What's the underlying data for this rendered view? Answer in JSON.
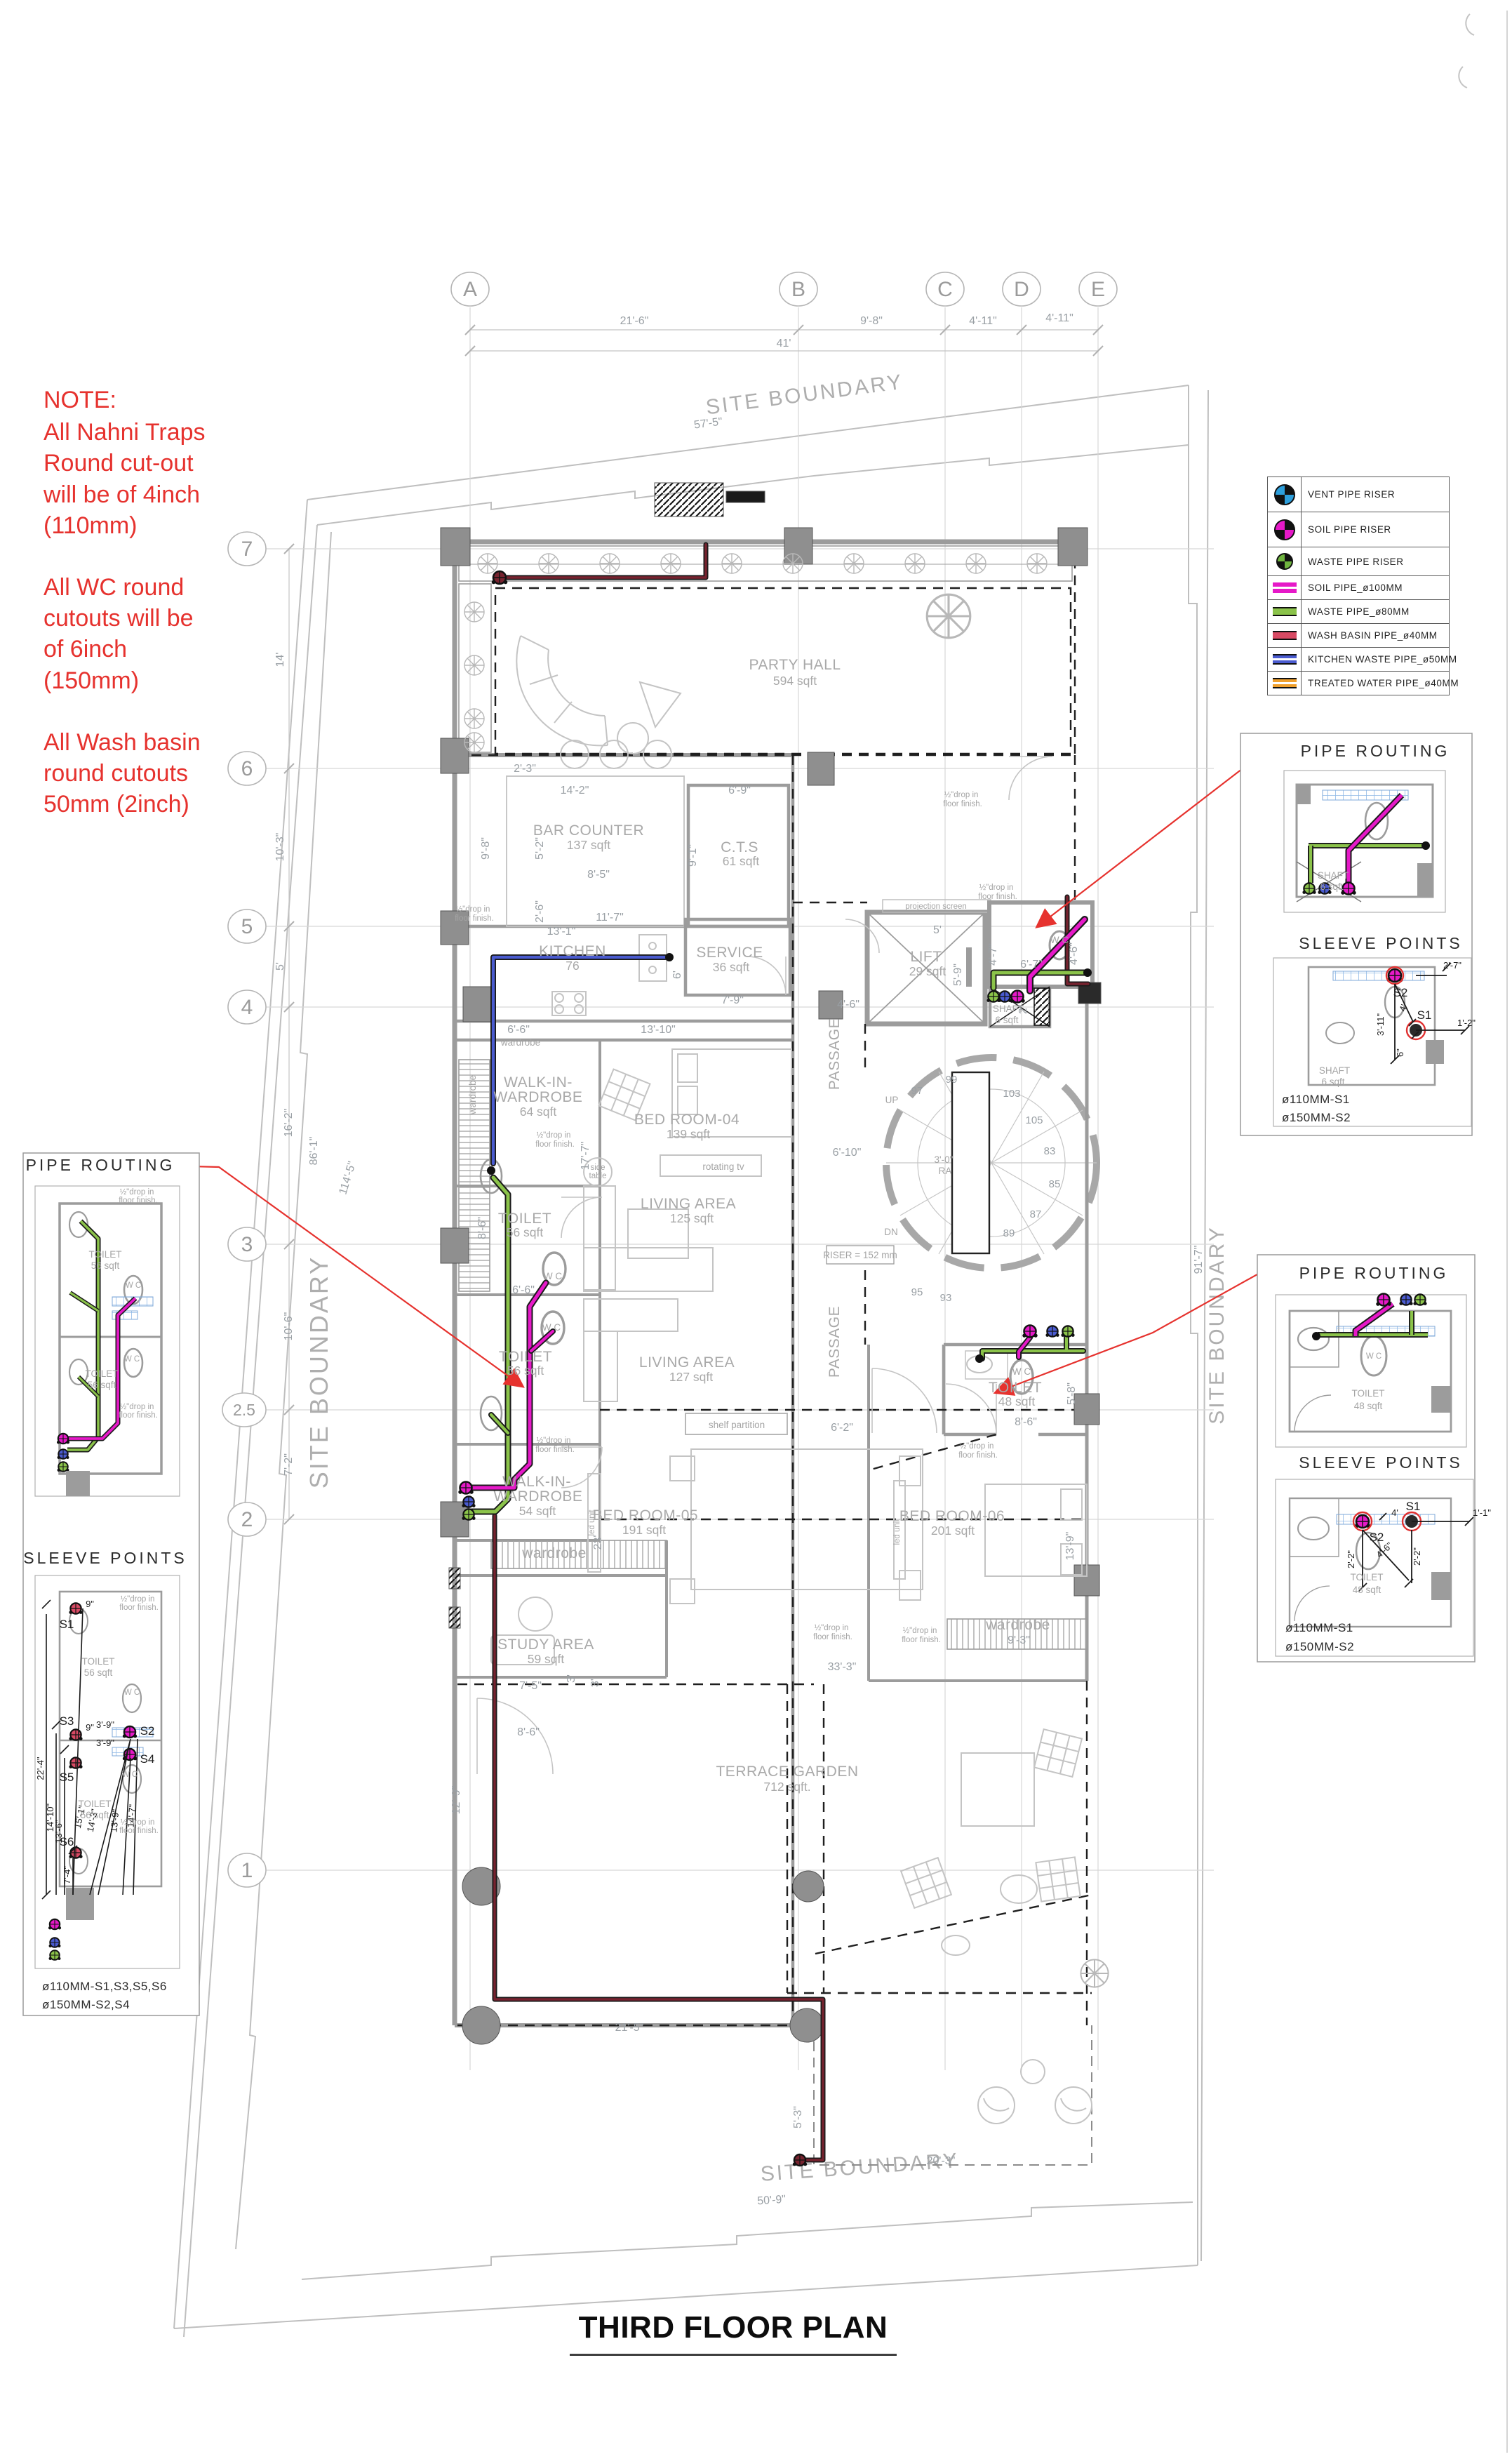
{
  "title": "THIRD FLOOR PLAN",
  "note": {
    "heading": "NOTE:",
    "p1": "All Nahni Traps\nRound cut-out\nwill be of 4inch\n(110mm)",
    "p2": "All WC round\ncutouts will be\nof 6inch\n(150mm)",
    "p3": "All Wash basin\nround cutouts\n50mm (2inch)"
  },
  "legend": {
    "items": [
      {
        "icon": "vent-pipe-riser-icon",
        "label": "VENT PIPE RISER",
        "color": "#2d9fdc"
      },
      {
        "icon": "soil-pipe-riser-icon",
        "label": "SOIL PIPE RISER",
        "color": "#e619c8"
      },
      {
        "icon": "waste-pipe-riser-icon",
        "label": "WASTE PIPE RISER",
        "color": "#6fb43f"
      },
      {
        "icon": "soil-pipe-line-icon",
        "label": "SOIL PIPE_ø100MM",
        "color": "#e619c8"
      },
      {
        "icon": "waste-pipe-line-icon",
        "label": "WASTE PIPE_ø80MM",
        "color": "#8bc34a"
      },
      {
        "icon": "wash-basin-pipe-icon",
        "label": "WASH BASIN PIPE_ø40MM",
        "color": "#d84a64"
      },
      {
        "icon": "kitchen-waste-pipe-icon",
        "label": "KITCHEN WASTE PIPE_ø50MM",
        "color": "#4a5bd0"
      },
      {
        "icon": "treated-water-pipe-icon",
        "label": "TREATED WATER PIPE_ø40MM",
        "color": "#f0a02c"
      }
    ]
  },
  "grid": {
    "cols": [
      "A",
      "B",
      "C",
      "D",
      "E"
    ],
    "rows": [
      "7",
      "6",
      "5",
      "4",
      "3",
      "2.5",
      "2",
      "1"
    ]
  },
  "dims": {
    "top": [
      "21'-6\"",
      "9'-8\"",
      "4'-11\"",
      "4'-11\"",
      "41'"
    ],
    "left": [
      "14'",
      "10'-3\"",
      "5'",
      "16'-2\"",
      "10'-6\"",
      "7'-2\""
    ],
    "boundary": {
      "label": "SITE BOUNDARY",
      "top": "57'-5\"",
      "left": "86'-1\"",
      "left_diag": "114'-5\"",
      "right": "91'-7\"",
      "bottom": "50'-9\""
    },
    "plan": [
      "2'-3\"",
      "14'-2\"",
      "6'-9\"",
      "9'-8\"",
      "5'-2\"",
      "8'-5\"",
      "2'-6\"",
      "11'-7\"",
      "9'-1\"",
      "13'-1\"",
      "6'",
      "7'-9\"",
      "6'-6\"",
      "13'-10\"",
      "8'-6\"",
      "17'-7\"",
      "6'-6\"",
      "4'-6\"",
      "5'",
      "5'-9\"",
      "4'-7\"",
      "6'-7\"",
      "2'",
      "4'-6\"",
      "6'-10\"",
      "6'-2\"",
      "8'-6\"",
      "5'-8\"",
      "13'-9\"",
      "23'",
      "9'-3\"",
      "33'-3\"",
      "7'-5\"",
      "8'-6\"",
      "12'-9\"",
      "21'-5\"",
      "5'-3\"",
      "20'-3\"",
      "3'",
      "3'"
    ]
  },
  "rooms": {
    "party": {
      "n": "PARTY HALL",
      "a": "594 sqft"
    },
    "bar": {
      "n": "BAR COUNTER",
      "a": "137 sqft"
    },
    "cts": {
      "n": "C.T.S",
      "a": "61 sqft"
    },
    "kitchen": {
      "n": "KITCHEN",
      "a": "76"
    },
    "service": {
      "n": "SERVICE",
      "a": "36 sqft"
    },
    "lift": {
      "n": "LIFT",
      "a": "29 sqft"
    },
    "shaft": {
      "n": "SHAFT",
      "a": "6 sqft"
    },
    "wiw64": {
      "n1": "WALK-IN-",
      "n2": "WARDROBE",
      "a": "64 sqft"
    },
    "bed04": {
      "n": "BED ROOM-04",
      "a": "139 sqft"
    },
    "living125": {
      "n": "LIVING AREA",
      "a": "125 sqft"
    },
    "toilet56a": {
      "n": "TOILET",
      "a": "56 sqft"
    },
    "toilet56b": {
      "n": "TOILET",
      "a": "56 sqft"
    },
    "living127": {
      "n": "LIVING AREA",
      "a": "127 sqft"
    },
    "wiw54": {
      "n1": "WALK-IN-",
      "n2": "WARDROBE",
      "a": "54 sqft"
    },
    "bed05": {
      "n": "BED ROOM-05",
      "a": "191 sqft"
    },
    "study": {
      "n": "STUDY AREA",
      "a": "59 sqft"
    },
    "bed06": {
      "n": "BED ROOM-06",
      "a": "201 sqft"
    },
    "toilet48": {
      "n": "TOILET",
      "a": "48 sqft"
    },
    "terrace": {
      "n": "TERRACE GARDEN",
      "a": "712 sqft."
    }
  },
  "labels": {
    "site_boundary": "SITE BOUNDARY",
    "projection_screen": "projection screen",
    "rotating_tv": "rotating tv",
    "shelf_partition": "shelf partition",
    "side": "side",
    "table": "table",
    "led_unit": "led unit",
    "wardrobe": "wardrobe",
    "wc": "W C",
    "drop1": "½\"drop in",
    "drop2": "floor finish.",
    "up": "UP",
    "dn": "DN",
    "riser_note": "RISER = 152 mm",
    "radius": "3'-0\"",
    "ra": "RA",
    "passage": "PASSAGE"
  },
  "stair": {
    "numbers": [
      "97",
      "99",
      "103",
      "105",
      "83",
      "85",
      "87",
      "89",
      "95",
      "93"
    ]
  },
  "details": {
    "routing": "PIPE ROUTING",
    "sleeve": "SLEEVE POINTS",
    "left": {
      "toilet": "TOILET",
      "area": "56 sqft",
      "wc": "W C",
      "s": [
        "S1",
        "S3",
        "S5",
        "S6",
        "S2",
        "S4"
      ],
      "dims": [
        "22'-4\"",
        "14'-10\"",
        "13'-6\"",
        "7'-4\"",
        "15'-1\"",
        "14'-3\"",
        "13'-9\"",
        "14'-7\"",
        "3'-9\"",
        "3'-9\"",
        "9\"",
        "9\""
      ],
      "size1": "ø110MM-S1,S3,S5,S6",
      "size2": "ø150MM-S2,S4"
    },
    "right1": {
      "shaft": "SHAFT",
      "shaft_area": "6 sqft",
      "s1": "S1",
      "s2": "S2",
      "dims": [
        "2'-7\"",
        "3'-11\"",
        "4'",
        "1'-2\"",
        "6\""
      ],
      "size1": "ø110MM-S1",
      "size2": "ø150MM-S2"
    },
    "right2": {
      "toilet": "TOILET",
      "area": "48 sqft",
      "wc": "W C",
      "s1": "S1",
      "s2": "S2",
      "dims": [
        "2'-2\"",
        "4'-6\"",
        "2'-2\"",
        "1'-1\"",
        "4'"
      ],
      "size1": "ø110MM-S1",
      "size2": "ø150MM-S2"
    }
  }
}
